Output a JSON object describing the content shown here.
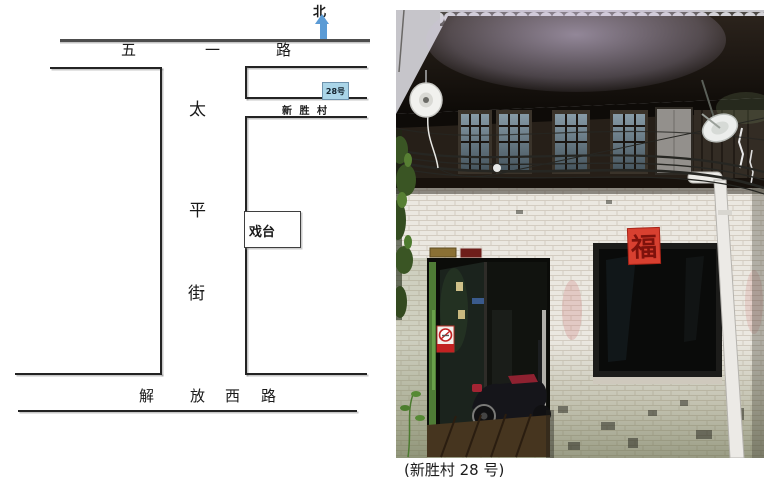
{
  "map": {
    "north_label": "北",
    "wuyi_road": {
      "chars": [
        "五",
        "一",
        "路"
      ]
    },
    "taiping_street": {
      "chars": [
        "太",
        "平",
        "街"
      ]
    },
    "jiefang_road": {
      "chars": [
        "解",
        "放",
        "西",
        "路"
      ]
    },
    "marker_28_label": "28号",
    "xinsheng_label": "新 胜 村",
    "stage_label": "戏台",
    "colors": {
      "arrow": "#5b9bd5",
      "marker_fill": "#aad5e8",
      "marker_border": "#6f93ad",
      "road_line": "#4d4d4d",
      "block_line": "#232323"
    }
  },
  "photo": {
    "caption": "(新胜村 28 号)",
    "fu_character": "福"
  }
}
